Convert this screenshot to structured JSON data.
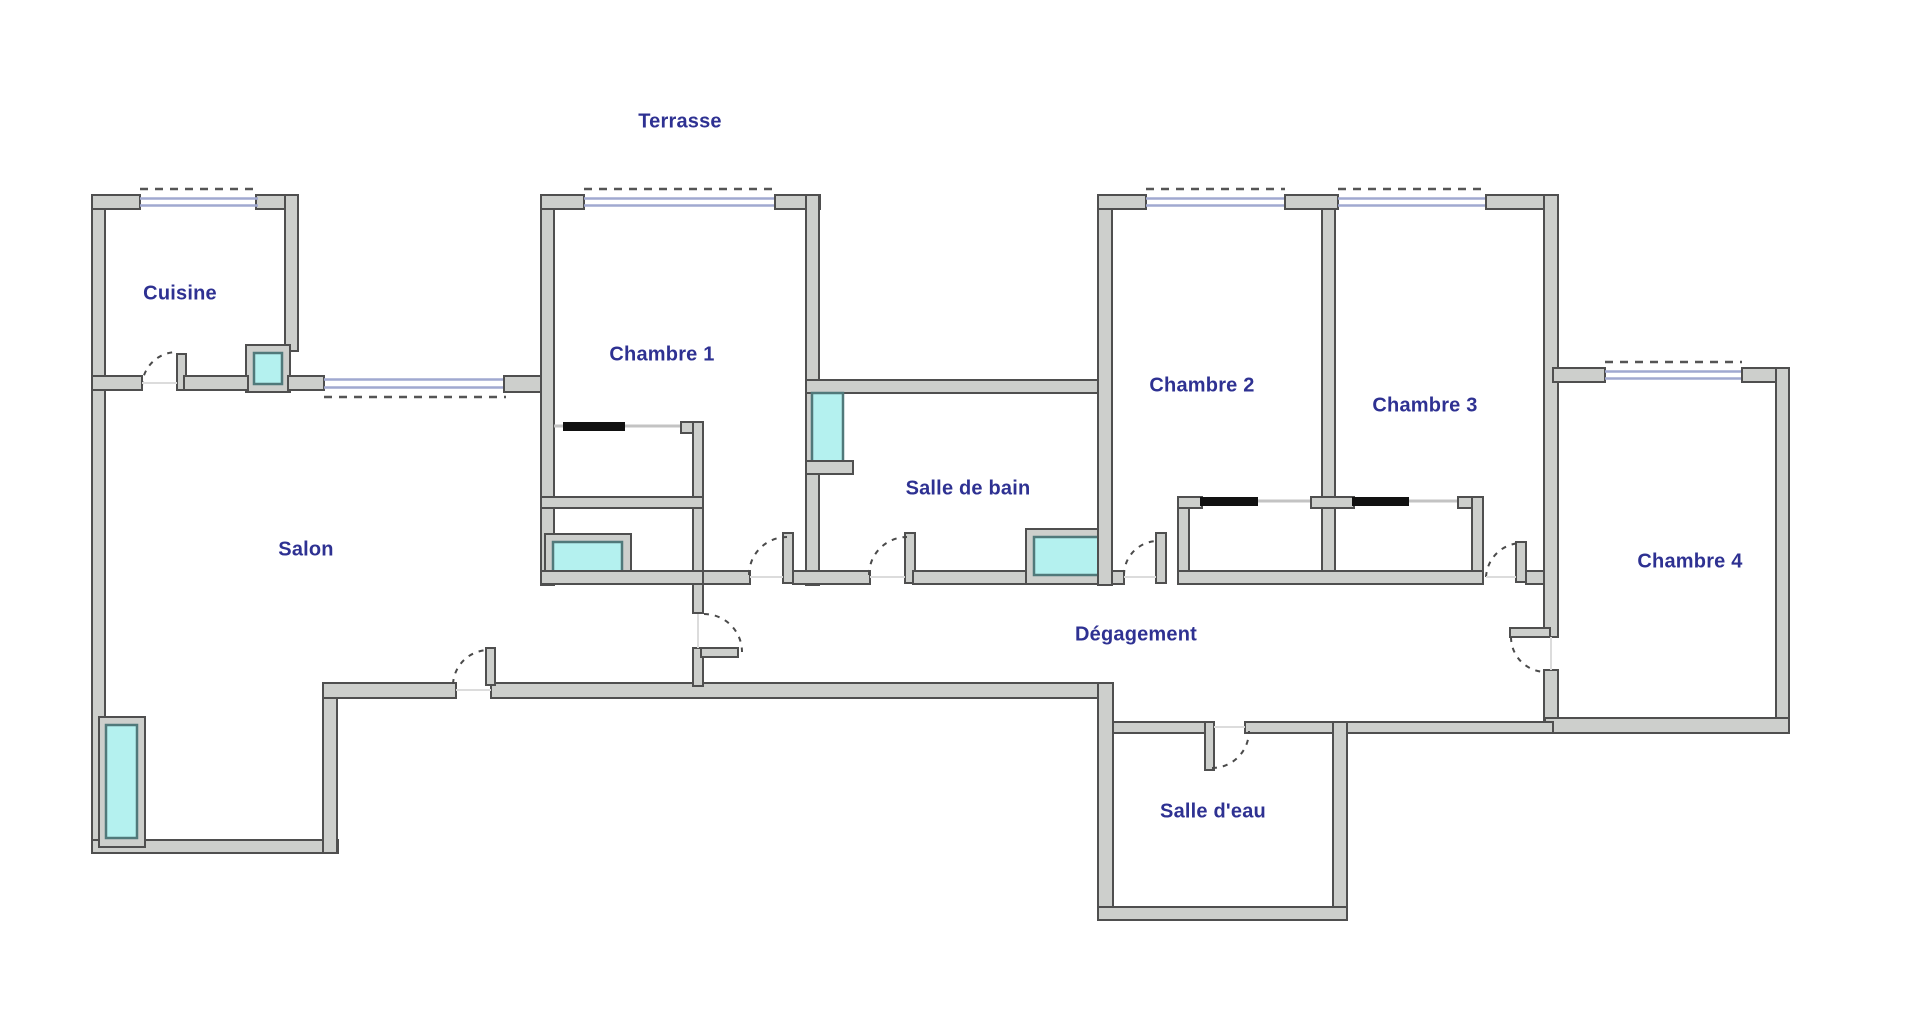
{
  "rooms": {
    "terrasse": {
      "label": "Terrasse"
    },
    "cuisine": {
      "label": "Cuisine"
    },
    "salon": {
      "label": "Salon"
    },
    "chambre_1": {
      "label": "Chambre 1"
    },
    "chambre_2": {
      "label": "Chambre 2"
    },
    "chambre_3": {
      "label": "Chambre 3"
    },
    "chambre_4": {
      "label": "Chambre 4"
    },
    "salle_de_bain": {
      "label": "Salle de bain"
    },
    "degagement": {
      "label": "Dégagement"
    },
    "salle_d_eau": {
      "label": "Salle d'eau"
    }
  },
  "colors": {
    "background": "#ffffff",
    "wall_fill": "#cdcfcc",
    "wall_outline": "#4f4f4f",
    "window_fill": "#b4f1ef",
    "window_outline": "#50797a",
    "glazing": "#a0a9d0",
    "label": "#2e3192",
    "door_arc": "#4a4a4a",
    "slider": "#111111",
    "track": "#c3c3c3",
    "threshold": "#dcdcdc"
  }
}
